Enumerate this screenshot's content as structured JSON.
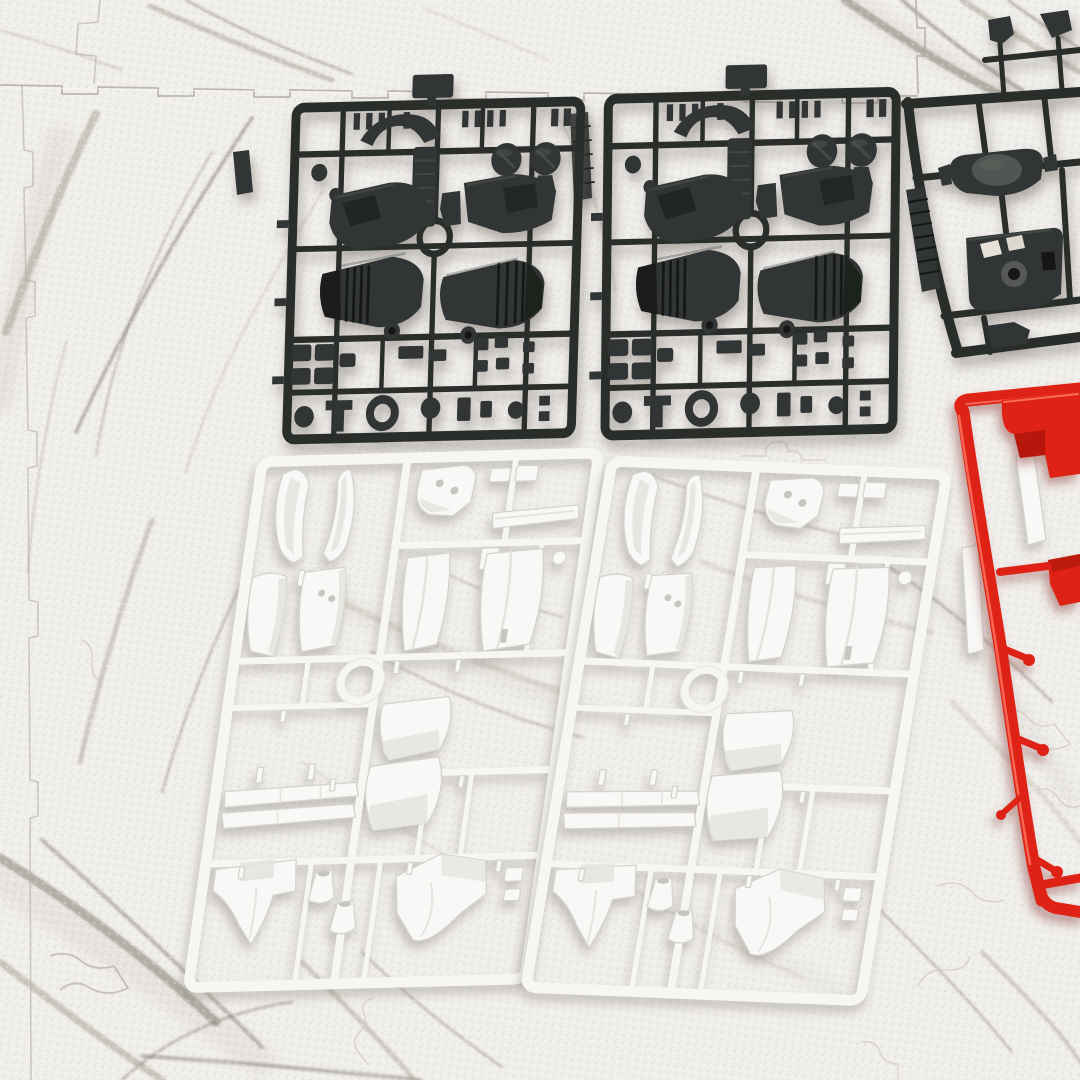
{
  "scene": {
    "description": "Top-down photograph of plastic model kit runners (sprues) laid out on a white marble-patterned interlocking foam puzzle mat: two identical dark-gray inner-frame runners at the top, a third dark runner cropped by the right edge, two identical white armor-panel runners below, and a bright red runner cropped at the right edge.",
    "surface": {
      "name": "marble-foam-puzzle-mat",
      "pattern": "white marble with gray-taupe veining",
      "features": [
        "interlocking jigsaw seams along top, left and right",
        "faint embossed jigsaw cut-lines",
        "fine pebble stipple texture"
      ]
    },
    "runners": [
      {
        "id": "black-runner-1",
        "color": "dark gray",
        "position": "top left",
        "notable_parts": [
          "ribbed leg engine cones x2",
          "slotted ankle domes x2",
          "backpack shell",
          "shoulder shell",
          "round gate ring",
          "ladder stack",
          "fitting squares grid",
          "wheel ring",
          "discs",
          "label tag"
        ]
      },
      {
        "id": "black-runner-2",
        "color": "dark gray",
        "position": "top center",
        "duplicate_of": "black-runner-1"
      },
      {
        "id": "black-runner-3",
        "color": "dark gray",
        "position": "top right, cropped by frame edge",
        "notable_parts": [
          "domed hip plate",
          "cored chest plate with cutouts",
          "ribbed label tag",
          "clip parts above rail"
        ]
      },
      {
        "id": "white-runner-1",
        "color": "white",
        "position": "bottom left",
        "notable_parts": [
          "curved shin fins x2",
          "head bracket",
          "thin blade",
          "side skirt",
          "front skirt with pin holes",
          "leg panels x2",
          "round gate ring",
          "rear skirts x2",
          "long slats x2",
          "chest cowl",
          "thruster bells x2",
          "waist collar"
        ]
      },
      {
        "id": "white-runner-2",
        "color": "white",
        "position": "bottom center",
        "duplicate_of": "white-runner-1"
      },
      {
        "id": "red-runner-1",
        "color": "bright red",
        "position": "right edge, mostly cropped",
        "notable_parts": [
          "notched armor block",
          "small stub parts with round gates"
        ]
      },
      {
        "id": "white-strip-parts",
        "color": "white",
        "position": "right edge beside red runner",
        "notable_parts": [
          "long thin strips x2"
        ]
      }
    ]
  },
  "palette": {
    "mat-base": "#f1efec",
    "mat-vein-light": "#c7c0b5",
    "mat-vein-mid": "#a39b8e",
    "mat-vein-dark": "#7d7568",
    "mat-seam": "#b3ada3",
    "mat-cutline": "#c6c0b6",
    "runner-black": "#2b2e2c",
    "runner-black-part": "#323634",
    "runner-black-hi": "#545955",
    "runner-black-dk": "#151817",
    "runner-white": "#f6f6f3",
    "runner-white-part": "#f8f8f6",
    "runner-white-line": "#d5d3cd",
    "runner-white-shade": "#e4e3de",
    "runner-white-hole": "#c6c5bf",
    "runner-red": "#df2317",
    "runner-red-dk": "#a51408",
    "runner-red-hi": "#ff7e68"
  }
}
